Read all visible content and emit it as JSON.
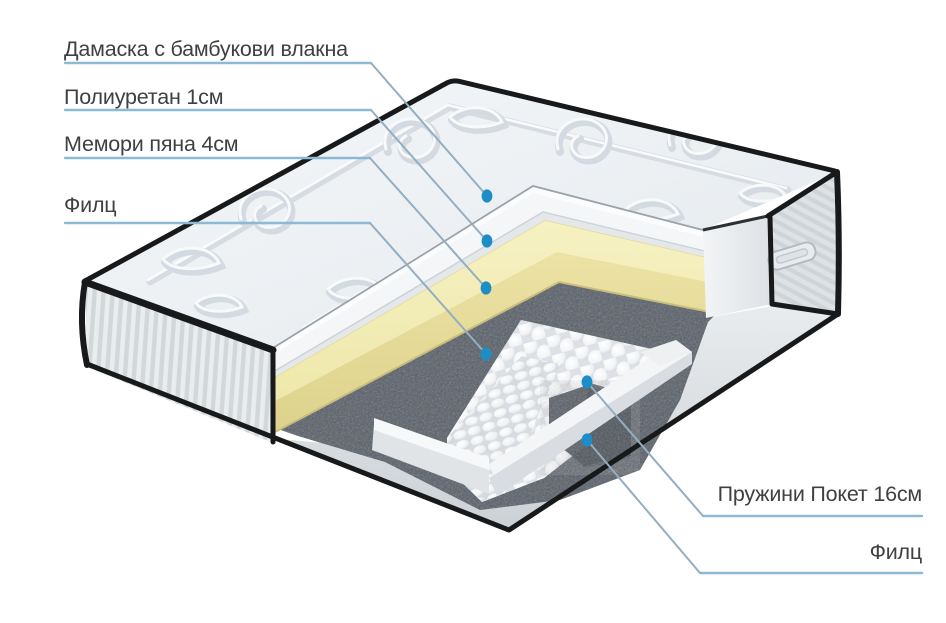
{
  "diagram": {
    "background": "#ffffff",
    "labels": {
      "damask": "Дамаска с бамбукови влакна",
      "polyurethane": "Полиуретан 1см",
      "memory_foam": "Мемори пяна 4см",
      "felt_top": "Филц",
      "springs": "Пружини Покет 16см",
      "felt_bottom": "Филц"
    },
    "colors": {
      "label_text": "#3e4041",
      "leader_line": "#93aec1",
      "underline": "#8cb9d4",
      "marker_dot": "#1d8dc5",
      "cover_fabric": "#eef1f4",
      "polyurethane_layer": "#f3f5f6",
      "memory_foam_top": "#f2edb6",
      "memory_foam_front": "#e7dd9d",
      "felt_layer": "#565d66",
      "springs": "#f5f7f8",
      "side_fabric": "#e6e9ec",
      "piping": "#18191b"
    }
  }
}
